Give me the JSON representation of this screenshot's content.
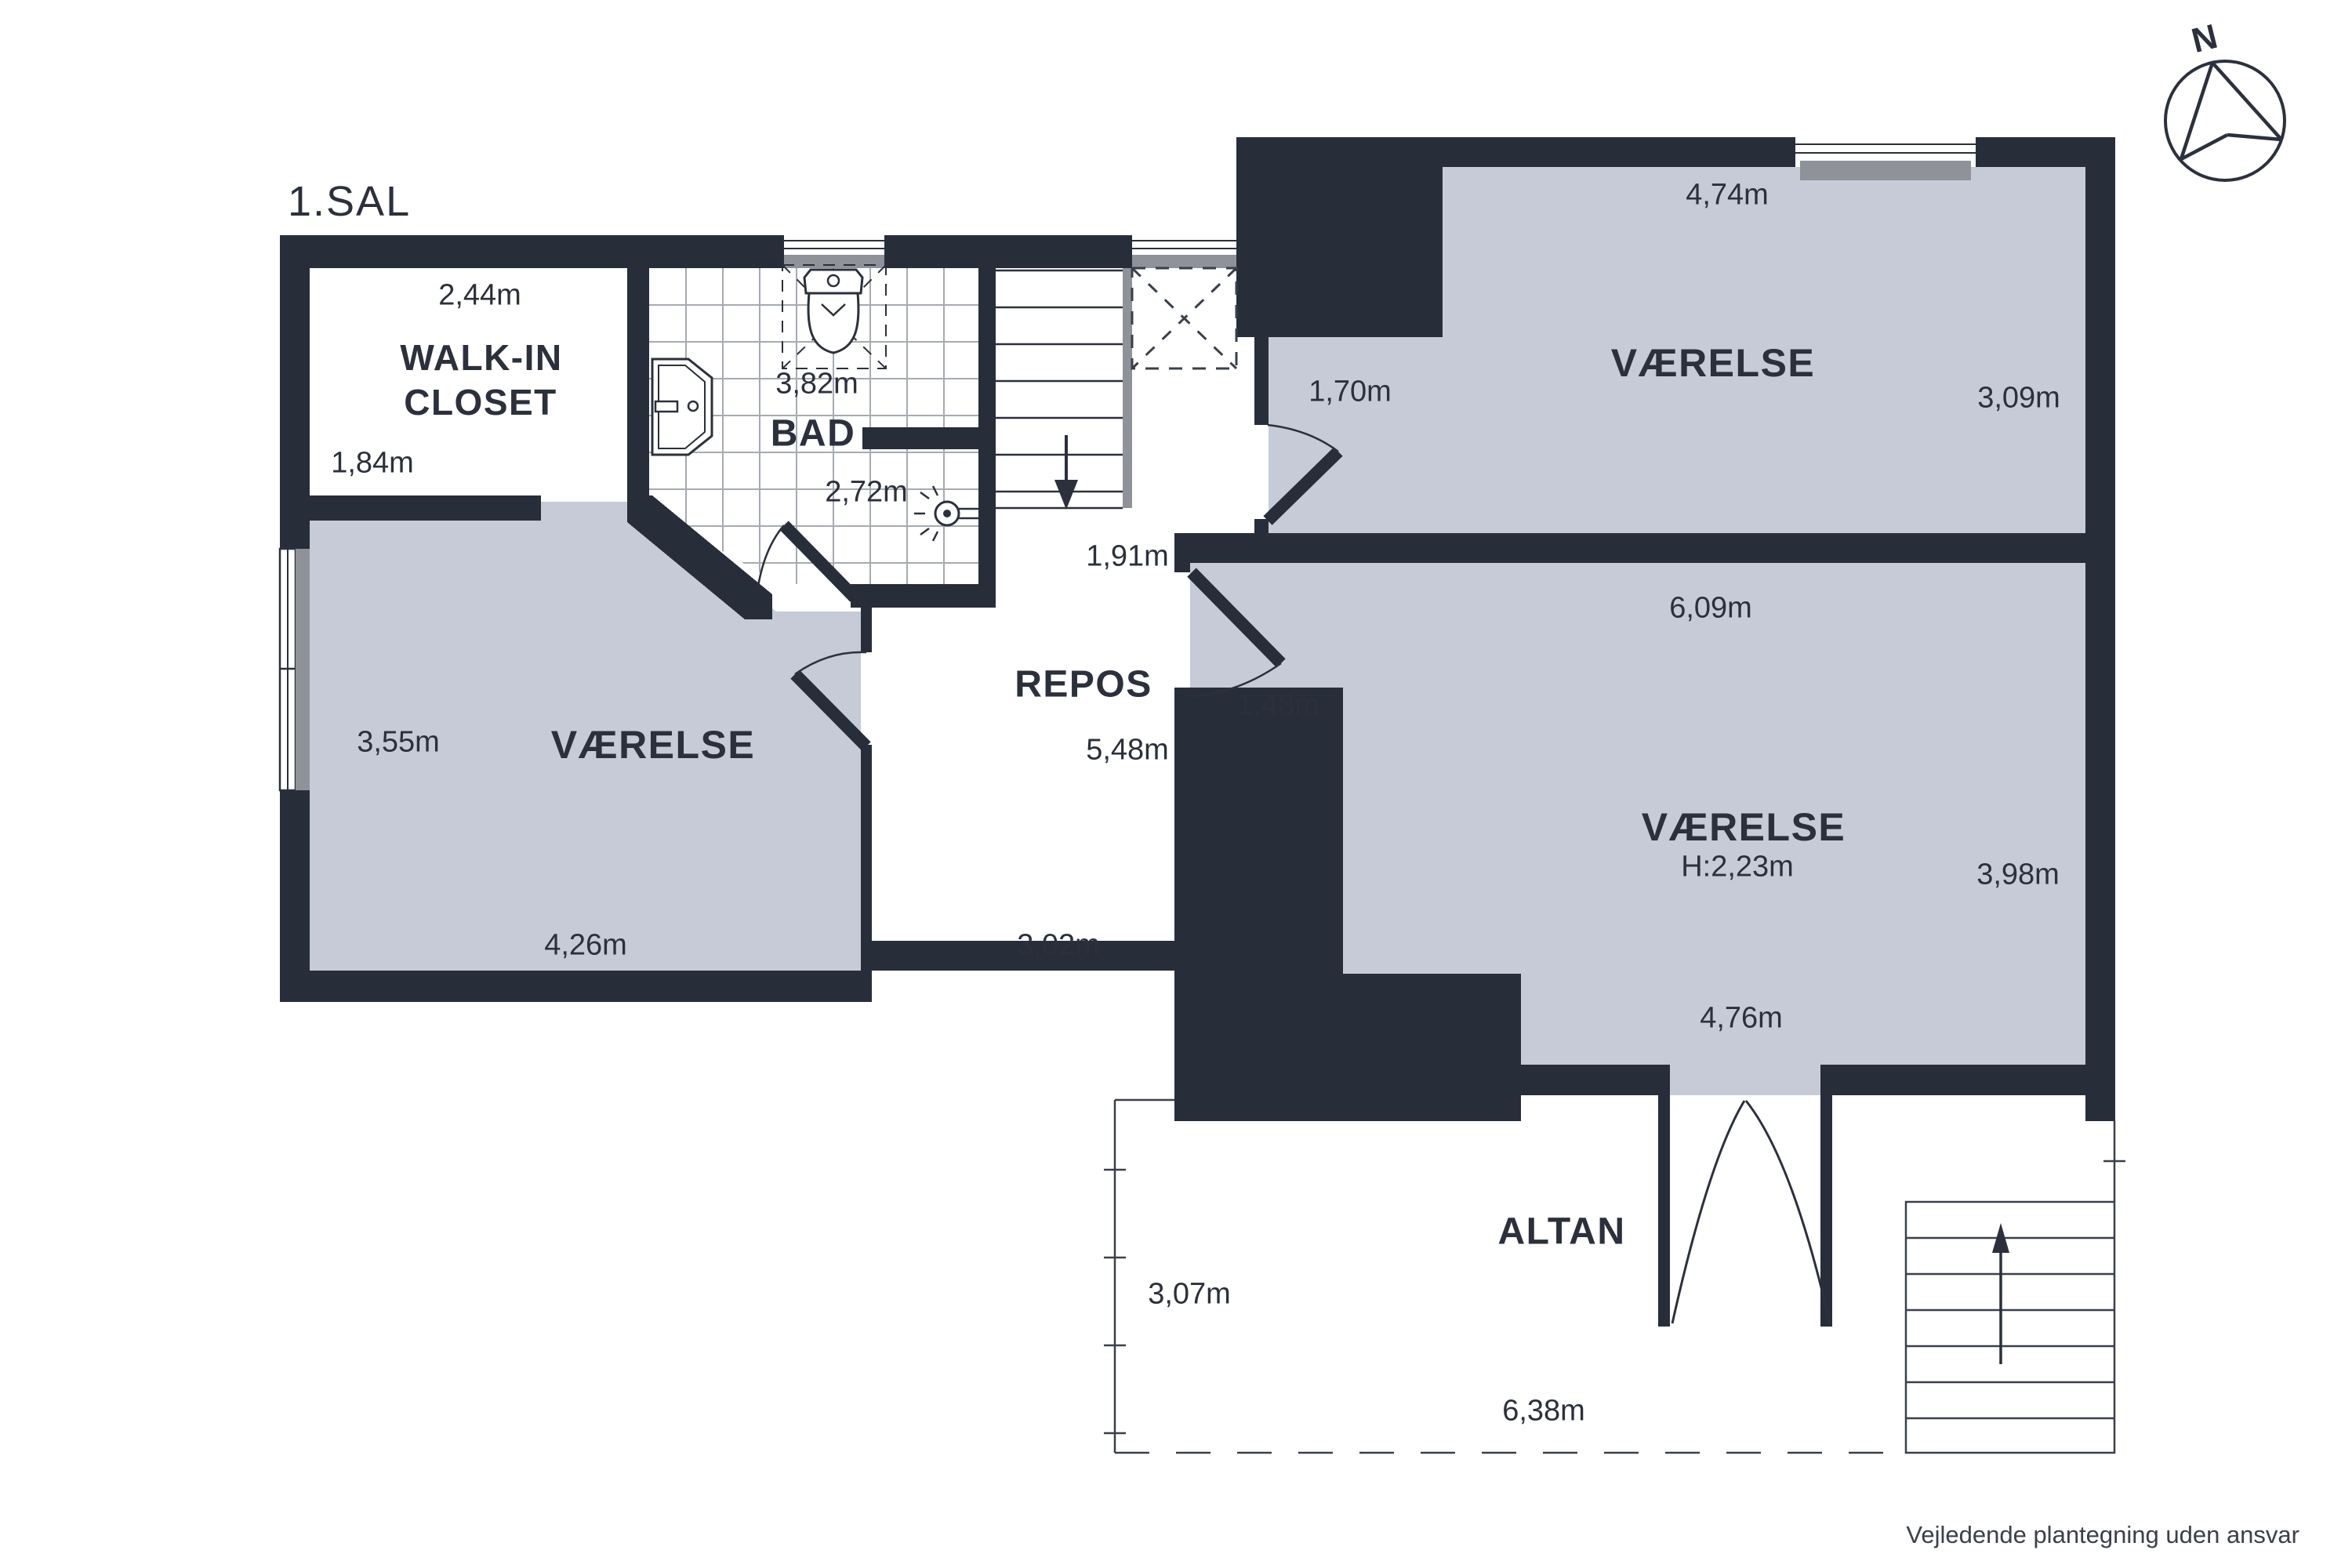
{
  "title": "1.SAL",
  "disclaimer": "Vejledende plantegning uden ansvar",
  "compass": {
    "north_label": "N"
  },
  "colors": {
    "wall": "#272e3a",
    "room_fill": "#c6cbd7",
    "sill_gray": "#8f9298",
    "tile_line": "#a6abb2",
    "text": "#2b303c"
  },
  "rooms": {
    "walk_in_closet": {
      "line1": "WALK-IN",
      "line2": "CLOSET",
      "width": "2,44m",
      "depth": "1,84m"
    },
    "bad": {
      "name": "BAD",
      "width": "3,82m",
      "depth": "2,72m"
    },
    "vaerelse_left": {
      "name": "VÆRELSE",
      "depth": "3,55m",
      "width": "4,26m"
    },
    "repos": {
      "name": "REPOS",
      "stair_width": "1,91m",
      "depth": "5,48m",
      "width": "3,02m"
    },
    "vaerelse_ne": {
      "name": "VÆRELSE",
      "width": "4,74m",
      "depth": "3,09m",
      "door_width": "1,70m"
    },
    "vaerelse_se": {
      "name": "VÆRELSE",
      "ceiling_height": "H:2,23m",
      "width_top": "6,09m",
      "door_width": "1,48m",
      "depth": "3,98m",
      "width_bottom": "4,76m"
    },
    "altan": {
      "name": "ALTAN",
      "depth": "3,07m",
      "width": "6,38m"
    }
  }
}
